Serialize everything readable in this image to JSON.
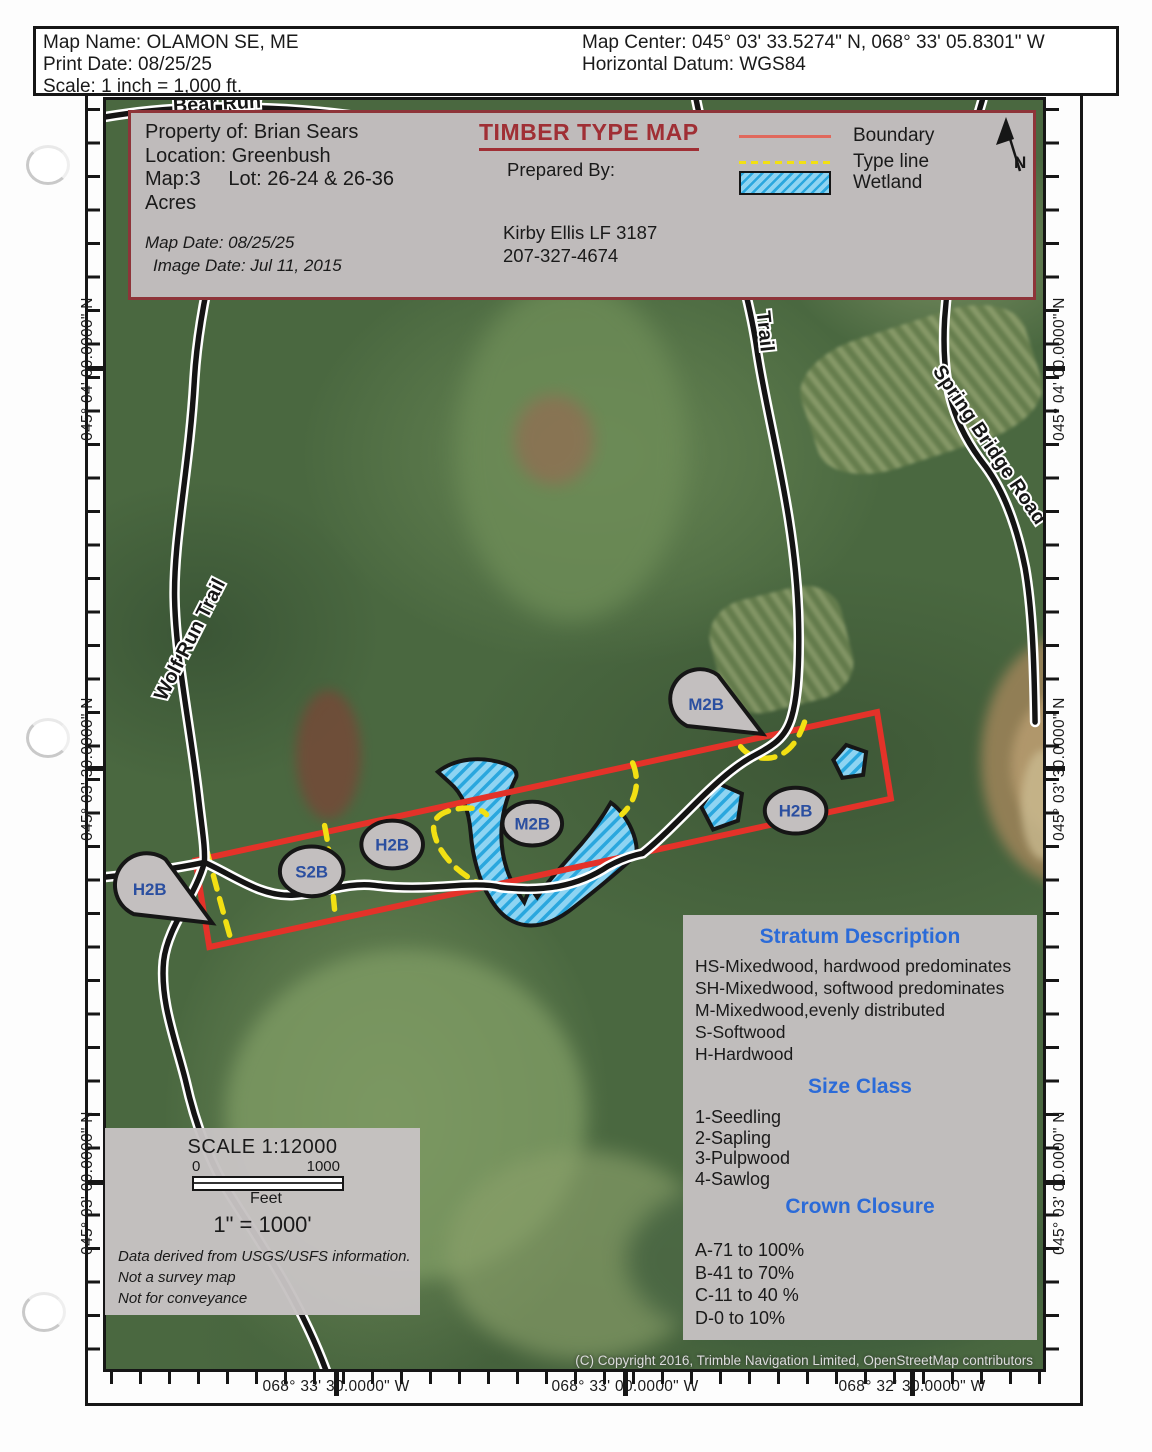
{
  "header": {
    "map_name": "Map Name: OLAMON SE, ME",
    "print_date": "Print Date: 08/25/25",
    "scale": "Scale: 1 inch = 1,000 ft.",
    "map_center": "Map Center: 045° 03' 33.5274\" N, 068° 33' 05.8301\" W",
    "horizontal_datum": "Horizontal Datum: WGS84"
  },
  "title_block": {
    "property_of": "Property of: Brian Sears",
    "location": "Location: Greenbush",
    "map_lot": "Map:3     Lot: 26-24 & 26-36",
    "acres": "Acres",
    "map_date": "Map Date: 08/25/25",
    "image_date": "Image Date: Jul 11, 2015",
    "title": "TIMBER TYPE MAP",
    "prepared_by_label": "Prepared By:",
    "preparer_name": "Kirby Ellis LF 3187",
    "preparer_phone": "207-327-4674",
    "north_label": "N",
    "legend": {
      "boundary": {
        "label": "Boundary",
        "color": "#e0685c"
      },
      "type_line": {
        "label": "Type line",
        "color": "#f2e013"
      },
      "wetland": {
        "label": "Wetland",
        "fill": "#8ed4f2",
        "hatch": "#2aa7de"
      }
    }
  },
  "map": {
    "road_labels": {
      "bear_run": "Bear Run",
      "wolf_run_trail": "Wolf Run Trail",
      "trail": "Trail",
      "spring_bridge_road": "Spring Bridge Road"
    },
    "markers": {
      "m2b_north": "M2B",
      "h2b_southwest": "H2B",
      "s2b": "S2B",
      "h2b_west": "H2B",
      "m2b_center": "M2B",
      "h2b_east": "H2B"
    },
    "boundary_color": "#e43229",
    "type_line_color": "#f2e013",
    "copyright": "(C) Copyright 2016, Trimble Navigation Limited, OpenStreetMap contributors"
  },
  "graticule": {
    "latitudes": [
      "045° 04' 00.0000\" N",
      "045° 03' 30.0000\" N",
      "045° 03' 00.0000\" N"
    ],
    "longitudes": [
      "068° 33' 30.0000\" W",
      "068° 33' 00.0000\" W",
      "068° 32' 30.0000\" W"
    ]
  },
  "stratum_box": {
    "heading": "Stratum Description",
    "stratum_lines": [
      "HS-Mixedwood, hardwood predominates",
      "SH-Mixedwood, softwood predominates",
      "M-Mixedwood,evenly distributed",
      "S-Softwood",
      "H-Hardwood"
    ],
    "size_heading": "Size Class",
    "size_lines": [
      "1-Seedling",
      "2-Sapling",
      "3-Pulpwood",
      "4-Sawlog"
    ],
    "crown_heading": "Crown Closure",
    "crown_lines": [
      "A-71 to 100%",
      "B-41 to 70%",
      "C-11 to 40 %",
      "D-0 to 10%"
    ],
    "heading_color": "#2b6bd8"
  },
  "scale_box": {
    "title": "SCALE 1:12000",
    "bar_start": "0",
    "bar_end": "1000",
    "bar_unit": "Feet",
    "equivalence": "1\" = 1000'",
    "notes": [
      "Data derived from USGS/USFS information.",
      "Not a survey map",
      "Not for conveyance"
    ]
  }
}
